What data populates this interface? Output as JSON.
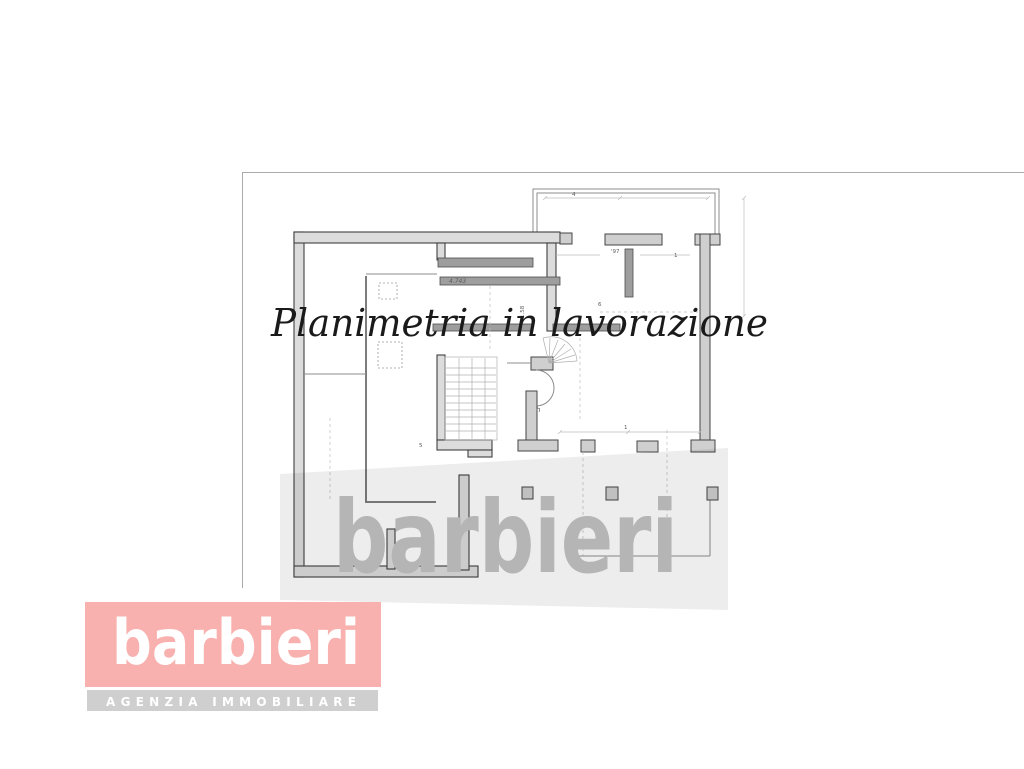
{
  "page": {
    "background": "#ffffff"
  },
  "floor_plan": {
    "type": "architectural-plan",
    "annotations": [
      {
        "text": "4.743"
      },
      {
        "text": "1.58"
      },
      {
        "text": "6"
      },
      {
        "text": "'97"
      },
      {
        "text": "1"
      },
      {
        "text": "h"
      },
      {
        "text": "5"
      },
      {
        "text": "1"
      },
      {
        "text": "4"
      }
    ]
  },
  "status_overlay": {
    "text": "Planimetria in lavorazione",
    "color": "#1a1a1a"
  },
  "watermark": {
    "text": "barbieri",
    "text_color": "#b5b5b5",
    "panel_color": "rgba(0,0,0,0.07)"
  },
  "logo": {
    "brand": "barbieri",
    "brand_color": "#ffffff",
    "background_color": "#f8b1ae",
    "tagline": "AGENZIA IMMOBILIARE",
    "tagline_color": "#ffffff",
    "tagline_background": "#cfcfcf"
  }
}
